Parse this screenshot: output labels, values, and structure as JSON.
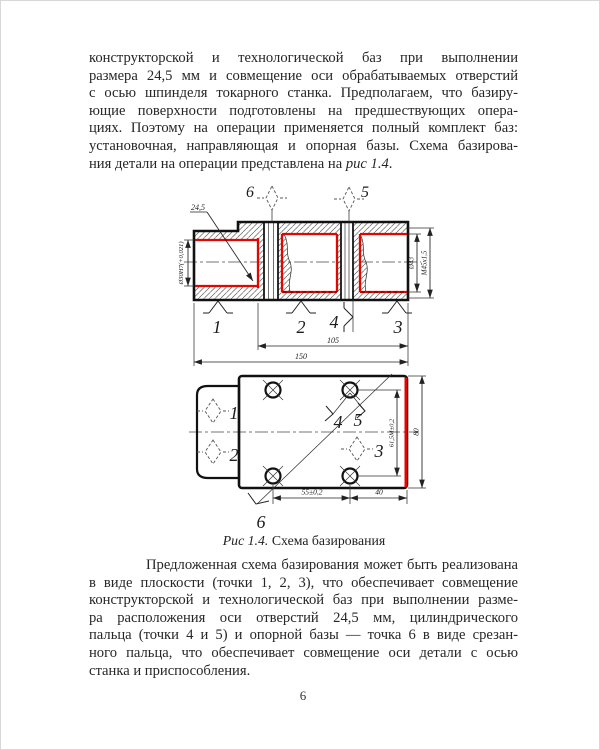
{
  "page": {
    "number": "6"
  },
  "body": {
    "p1": {
      "lines": [
        "конструкторской и технологической баз при выполнении",
        "размера 24,5 мм и совмещение оси обрабатываемых отверстий",
        "с осью шпинделя токарного станка. Предполагаем, что базиру-",
        "ющие поверхности подготовлены на предшествующих опера-",
        "циях. Поэтому на операции применяется полный комплект баз:",
        "установочная, направляющая и опорная базы. Схема базирова-"
      ],
      "last_before": "ния детали на операции представлена на ",
      "last_italic": "рис 1.4",
      "last_after": "."
    },
    "p2": {
      "lines": [
        "Предложенная схема базирования может быть реализована",
        "в виде плоскости (точки 1, 2, 3), что обеспечивает совмещение",
        "конструкторской и технологической баз при выполнении разме-",
        "ра расположения оси отверстий 24,5 мм, цилиндрического",
        "пальца (точки 4 и 5) и опорной базы — точка 6 в виде срезан-",
        "ного пальца, что обеспечивает совмещение оси детали с осью"
      ],
      "last_line": "станка и приспособления."
    }
  },
  "figure": {
    "caption_italic": "Рис 1.4.",
    "caption_text": "Схема базирования",
    "colors": {
      "highlight": "#e10600"
    },
    "section": {
      "leader_dim": "24,5",
      "bore_dim": "Ø30Н7(+0,021)",
      "right_dim_inner": "Ø43",
      "right_dim_outer": "М45х1,5",
      "length_dim_inner": "105",
      "length_dim_outer": "150",
      "datum_top_left": "6",
      "datum_top_right": "5",
      "point_left": "1",
      "point_mid": "2",
      "point_side": "4",
      "point_right": "3"
    },
    "plan": {
      "datum_upper": "1",
      "datum_lower": "2",
      "datum_right": "3",
      "point_hole_left": "4",
      "point_hole_right": "5",
      "point_corner": "6",
      "holes_dim": "55±0,2",
      "edge_dim": "40",
      "height_dim": "80",
      "vertical_holes_dim": "61,5М±0,2"
    }
  }
}
